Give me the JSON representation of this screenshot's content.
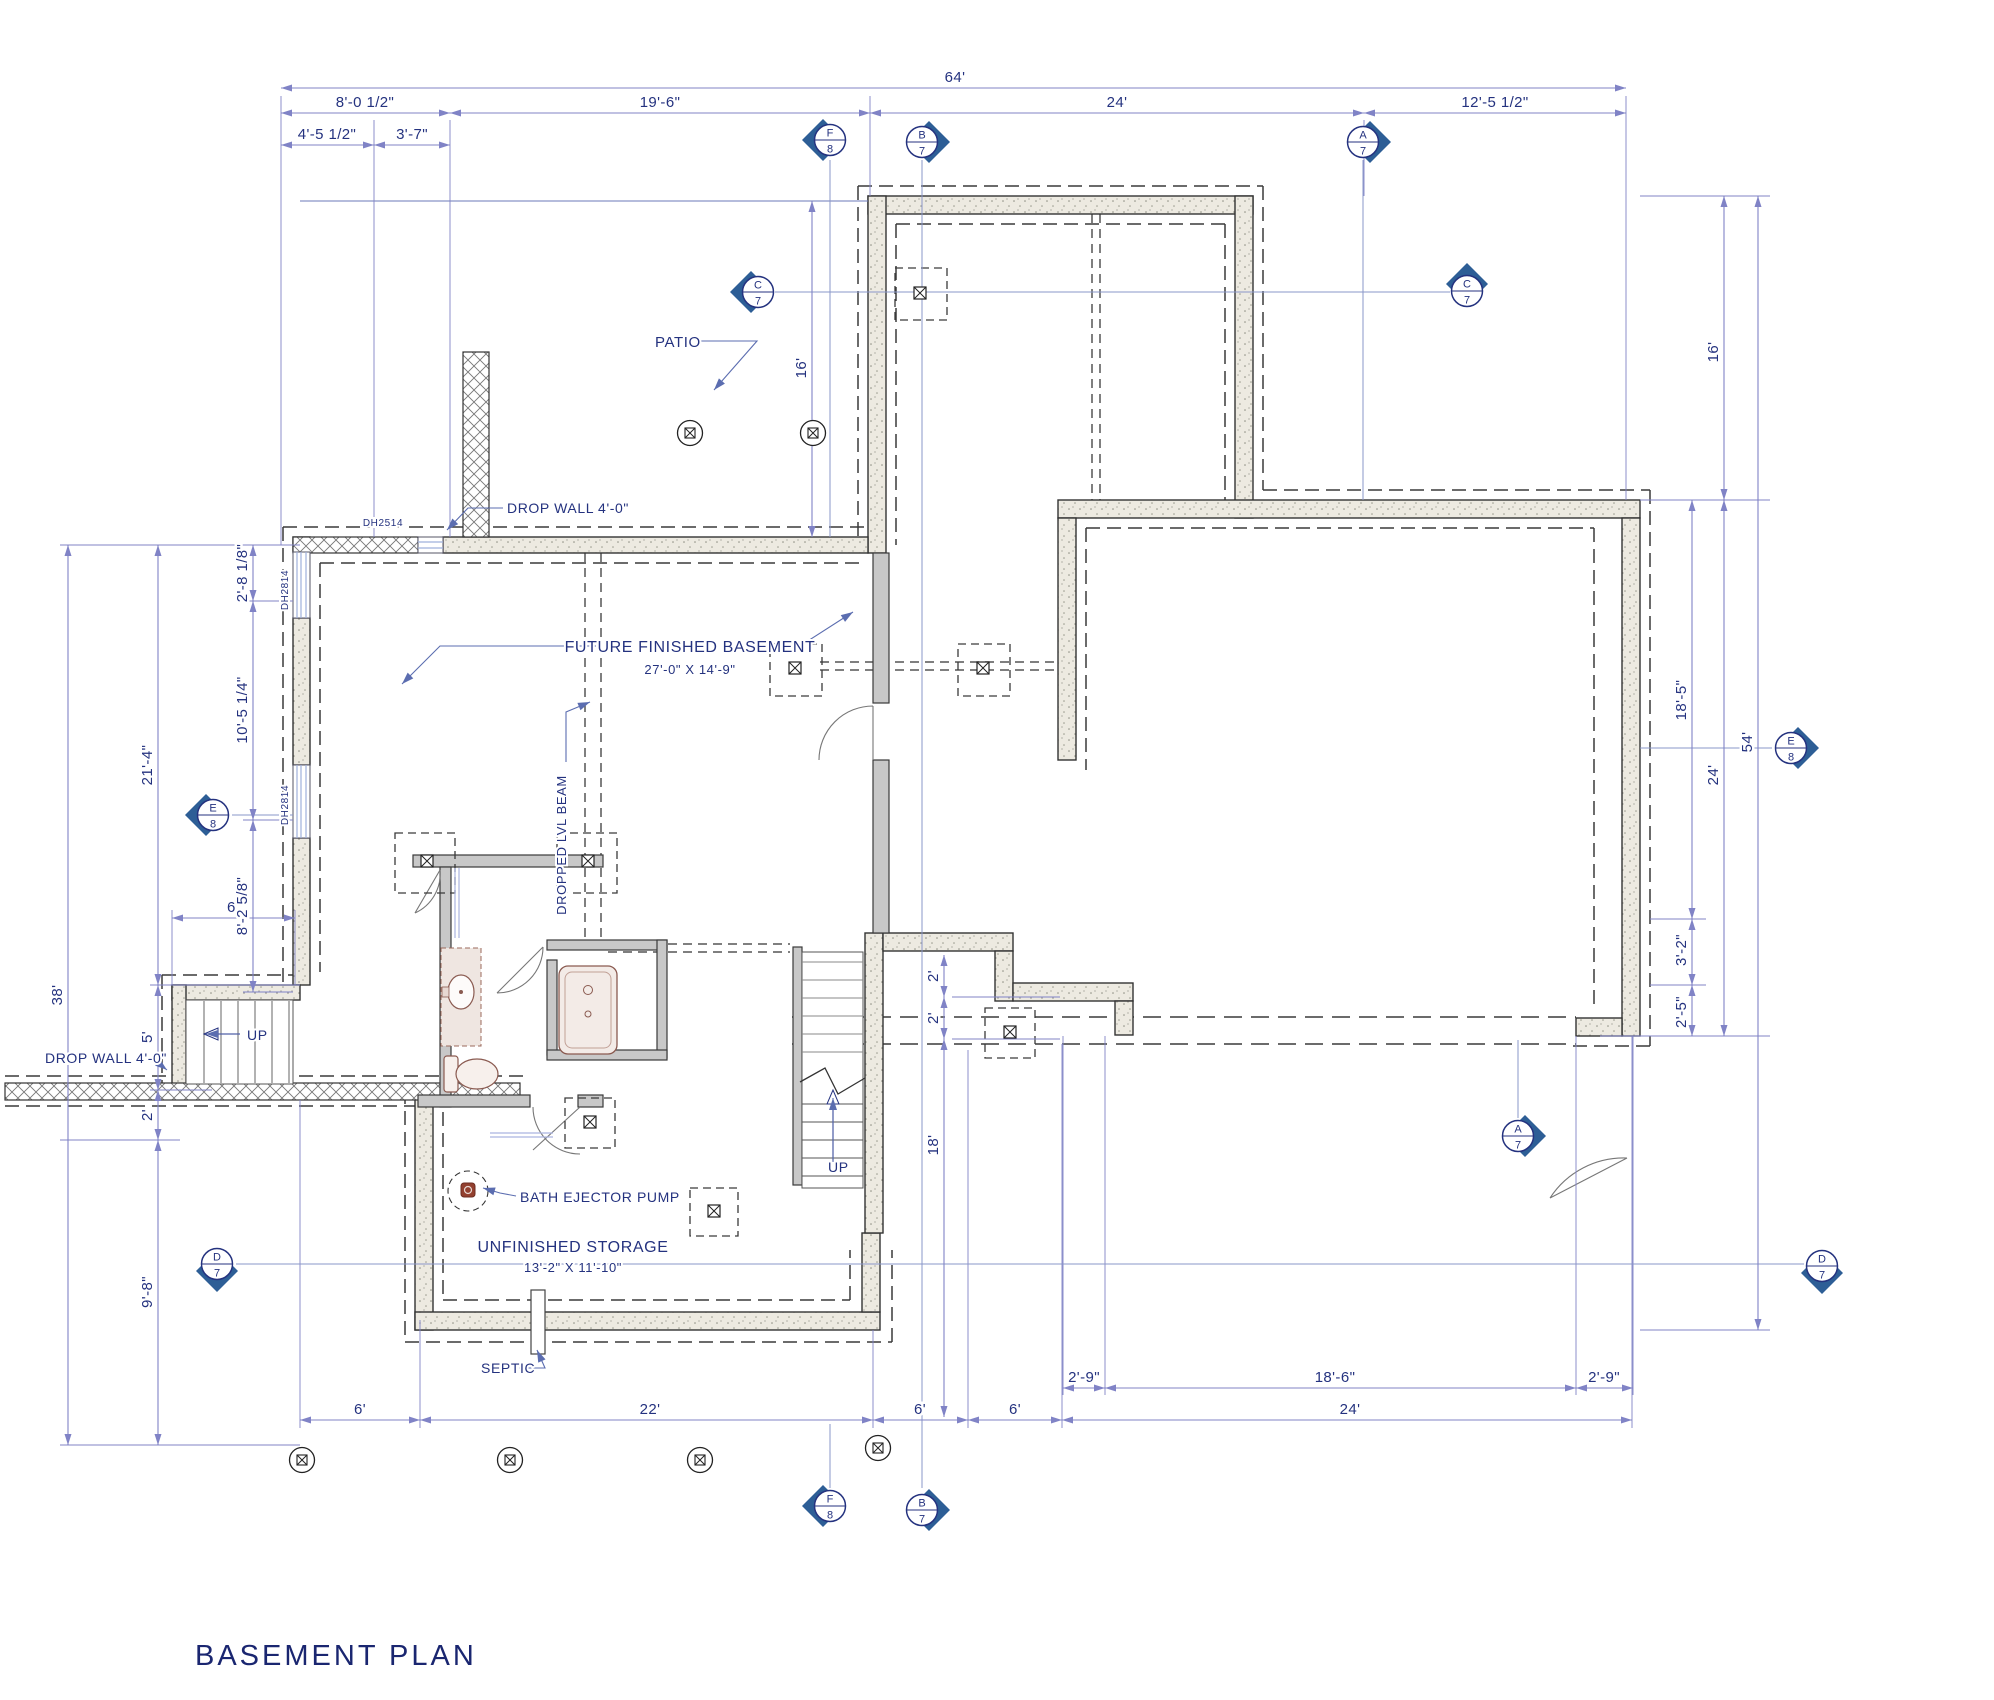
{
  "title": {
    "text": "BASEMENT PLAN"
  },
  "colors": {
    "annotation_text": "#24327f",
    "dimension_line": "#8083c6",
    "section_line": "#8a97c9",
    "marker_diamond": "#2d5e96",
    "wall_outline": "#333333",
    "concrete_fill": "#edeae1",
    "interior_wall": "#c8c8c8",
    "fixture": "#8a5a50",
    "pump_red": "#93402f"
  },
  "dims": [
    {
      "t": "64'",
      "x1": 281,
      "x2": 1626,
      "y": 88,
      "tx": 955,
      "ty": 82
    },
    {
      "t": "8'-0 1/2\"",
      "x1": 281,
      "x2": 450,
      "y": 113,
      "tx": 365,
      "ty": 107
    },
    {
      "t": "19'-6\"",
      "x1": 450,
      "x2": 870,
      "y": 113,
      "tx": 660,
      "ty": 107
    },
    {
      "t": "24'",
      "x1": 870,
      "x2": 1364,
      "y": 113,
      "tx": 1117,
      "ty": 107
    },
    {
      "t": "12'-5 1/2\"",
      "x1": 1364,
      "x2": 1626,
      "y": 113,
      "tx": 1495,
      "ty": 107
    },
    {
      "t": "4'-5 1/2\"",
      "x1": 281,
      "x2": 374,
      "y": 145,
      "tx": 327,
      "ty": 139
    },
    {
      "t": "3'-7\"",
      "x1": 374,
      "x2": 450,
      "y": 145,
      "tx": 412,
      "ty": 139
    },
    {
      "t": "6'",
      "x1": 300,
      "x2": 420,
      "y": 1420,
      "tx": 360,
      "ty": 1414
    },
    {
      "t": "22'",
      "x1": 420,
      "x2": 873,
      "y": 1420,
      "tx": 650,
      "ty": 1414
    },
    {
      "t": "6'",
      "x1": 873,
      "x2": 968,
      "y": 1420,
      "tx": 920,
      "ty": 1414
    },
    {
      "t": "6'",
      "x1": 968,
      "x2": 1062,
      "y": 1420,
      "tx": 1015,
      "ty": 1414
    },
    {
      "t": "24'",
      "x1": 1062,
      "x2": 1632,
      "y": 1420,
      "tx": 1350,
      "ty": 1414
    },
    {
      "t": "2'-9\"",
      "x1": 1063,
      "x2": 1105,
      "y": 1388,
      "tx": 1084,
      "ty": 1382
    },
    {
      "t": "18'-6\"",
      "x1": 1105,
      "x2": 1576,
      "y": 1388,
      "tx": 1335,
      "ty": 1382
    },
    {
      "t": "2'-9\"",
      "x1": 1576,
      "x2": 1633,
      "y": 1388,
      "tx": 1604,
      "ty": 1382
    },
    {
      "t": "6'",
      "x1": 172,
      "x2": 295,
      "y": 918,
      "tx": 233,
      "ty": 912
    },
    {
      "t": "38'",
      "x": 68,
      "y1": 545,
      "y2": 1445,
      "tx": 62,
      "ty": 995,
      "rot": -90
    },
    {
      "t": "21'-4\"",
      "x": 158,
      "y1": 545,
      "y2": 985,
      "tx": 152,
      "ty": 765,
      "rot": -90
    },
    {
      "t": "5'",
      "x": 158,
      "y1": 985,
      "y2": 1090,
      "tx": 152,
      "ty": 1037,
      "rot": -90
    },
    {
      "t": "2'",
      "x": 158,
      "y1": 1090,
      "y2": 1140,
      "tx": 152,
      "ty": 1115,
      "rot": -90
    },
    {
      "t": "9'-8\"",
      "x": 158,
      "y1": 1140,
      "y2": 1445,
      "tx": 152,
      "ty": 1292,
      "rot": -90
    },
    {
      "t": "2'-8 1/8\"",
      "x": 253,
      "y1": 545,
      "y2": 601,
      "tx": 247,
      "ty": 573,
      "rot": -90
    },
    {
      "t": "10'-5 1/4\"",
      "x": 253,
      "y1": 601,
      "y2": 820,
      "tx": 247,
      "ty": 710,
      "rot": -90
    },
    {
      "t": "8'-2 5/8\"",
      "x": 253,
      "y1": 820,
      "y2": 992,
      "tx": 247,
      "ty": 906,
      "rot": -90
    },
    {
      "t": "16'",
      "x": 812,
      "y1": 201,
      "y2": 537,
      "tx": 806,
      "ty": 368,
      "rot": -90
    },
    {
      "t": "16'",
      "x": 1724,
      "y1": 196,
      "y2": 500,
      "tx": 1718,
      "ty": 352,
      "rot": -90
    },
    {
      "t": "24'",
      "x": 1724,
      "y1": 500,
      "y2": 1036,
      "tx": 1718,
      "ty": 775,
      "rot": -90
    },
    {
      "t": "18'-5\"",
      "x": 1692,
      "y1": 500,
      "y2": 919,
      "tx": 1686,
      "ty": 700,
      "rot": -90
    },
    {
      "t": "3'-2\"",
      "x": 1692,
      "y1": 919,
      "y2": 985,
      "tx": 1686,
      "ty": 950,
      "rot": -90
    },
    {
      "t": "2'-5\"",
      "x": 1692,
      "y1": 985,
      "y2": 1036,
      "tx": 1686,
      "ty": 1012,
      "rot": -90
    },
    {
      "t": "54'",
      "x": 1758,
      "y1": 196,
      "y2": 1330,
      "tx": 1752,
      "ty": 742,
      "rot": -90
    },
    {
      "t": "2'",
      "x": 944,
      "y1": 955,
      "y2": 997,
      "tx": 938,
      "ty": 976,
      "rot": -90
    },
    {
      "t": "2'",
      "x": 944,
      "y1": 997,
      "y2": 1039,
      "tx": 938,
      "ty": 1018,
      "rot": -90
    },
    {
      "t": "18'",
      "x": 944,
      "y1": 1039,
      "y2": 1417,
      "tx": 938,
      "ty": 1145,
      "rot": -90
    }
  ],
  "labels": [
    {
      "id": "patio",
      "text": "PATIO",
      "x": 655,
      "y": 347,
      "size": 15,
      "anchor": "start"
    },
    {
      "id": "future-basement",
      "text": "FUTURE FINISHED BASEMENT",
      "x": 690,
      "y": 652,
      "size": 16,
      "anchor": "middle"
    },
    {
      "id": "future-basement-size",
      "text": "27'-0\" X 14'-9\"",
      "x": 690,
      "y": 674,
      "size": 13,
      "anchor": "middle"
    },
    {
      "id": "unfinished-storage",
      "text": "UNFINISHED STORAGE",
      "x": 573,
      "y": 1252,
      "size": 16,
      "anchor": "middle"
    },
    {
      "id": "unfinished-storage-size",
      "text": "13'-2\" X 11'-10\"",
      "x": 573,
      "y": 1272,
      "size": 13,
      "anchor": "middle"
    },
    {
      "id": "dropped-lvl-beam",
      "text": "DROPPED LVL BEAM",
      "x": 566,
      "y": 845,
      "size": 13,
      "anchor": "middle",
      "rot": -90
    },
    {
      "id": "drop-wall-top",
      "text": "DROP WALL 4'-0\"",
      "x": 507,
      "y": 513,
      "size": 14,
      "anchor": "start"
    },
    {
      "id": "drop-wall-left",
      "text": "DROP WALL 4'-0\"",
      "x": 45,
      "y": 1063,
      "size": 14,
      "anchor": "start"
    },
    {
      "id": "bath-ejector-pump",
      "text": "BATH EJECTOR PUMP",
      "x": 520,
      "y": 1202,
      "size": 14,
      "anchor": "start"
    },
    {
      "id": "septic",
      "text": "SEPTIC",
      "x": 481,
      "y": 1373,
      "size": 14,
      "anchor": "start"
    },
    {
      "id": "up-main-stair",
      "text": "UP",
      "x": 828,
      "y": 1172,
      "size": 14,
      "anchor": "start"
    },
    {
      "id": "up-left-stair",
      "text": "UP",
      "x": 247,
      "y": 1040,
      "size": 14,
      "anchor": "start"
    },
    {
      "id": "window-top",
      "text": "DH2514",
      "x": 383,
      "y": 526,
      "size": 10,
      "anchor": "middle"
    },
    {
      "id": "window-left-upper",
      "text": "DH2814",
      "x": 288,
      "y": 590,
      "size": 10,
      "anchor": "middle",
      "rot": -90
    },
    {
      "id": "window-left-lower",
      "text": "DH2814",
      "x": 288,
      "y": 805,
      "size": 10,
      "anchor": "middle",
      "rot": -90
    }
  ],
  "leaders": [
    {
      "for": "patio",
      "pts": [
        [
          700,
          341
        ],
        [
          757,
          341
        ],
        [
          714,
          390
        ]
      ]
    },
    {
      "for": "future-basement",
      "pts": [
        [
          596,
          646
        ],
        [
          440,
          646
        ],
        [
          402,
          684
        ]
      ]
    },
    {
      "for": "future-basement",
      "pts": [
        [
          784,
          646
        ],
        [
          800,
          646
        ],
        [
          853,
          612
        ]
      ]
    },
    {
      "for": "dropped-lvl-beam",
      "pts": [
        [
          566,
          762
        ],
        [
          566,
          712
        ],
        [
          590,
          702
        ]
      ]
    },
    {
      "for": "drop-wall-top",
      "pts": [
        [
          503,
          508
        ],
        [
          468,
          508
        ],
        [
          447,
          530
        ]
      ]
    },
    {
      "for": "drop-wall-left",
      "pts": [
        [
          142,
          1058
        ],
        [
          152,
          1058
        ],
        [
          167,
          1070
        ]
      ]
    },
    {
      "for": "bath-ejector-pump",
      "pts": [
        [
          516,
          1196
        ],
        [
          500,
          1193
        ],
        [
          483,
          1188
        ]
      ]
    },
    {
      "for": "septic",
      "pts": [
        [
          519,
          1368
        ],
        [
          545,
          1368
        ],
        [
          537,
          1350
        ]
      ]
    },
    {
      "for": "up-main-stair",
      "pts": [
        [
          833,
          1162
        ],
        [
          833,
          1098
        ]
      ]
    },
    {
      "for": "up-left-stair",
      "pts": [
        [
          240,
          1034
        ],
        [
          206,
          1034
        ]
      ]
    }
  ],
  "markers": [
    {
      "letter": "F",
      "number": "8",
      "x": 830,
      "y": 140,
      "dir": "left"
    },
    {
      "letter": "B",
      "number": "7",
      "x": 922,
      "y": 142,
      "dir": "right"
    },
    {
      "letter": "A",
      "number": "7",
      "x": 1363,
      "y": 142,
      "dir": "right"
    },
    {
      "letter": "C",
      "number": "7",
      "x": 758,
      "y": 292,
      "dir": "left"
    },
    {
      "letter": "C",
      "number": "7",
      "x": 1467,
      "y": 291,
      "dir": "up"
    },
    {
      "letter": "E",
      "number": "8",
      "x": 213,
      "y": 815,
      "dir": "left"
    },
    {
      "letter": "E",
      "number": "8",
      "x": 1791,
      "y": 748,
      "dir": "right"
    },
    {
      "letter": "D",
      "number": "7",
      "x": 217,
      "y": 1264,
      "dir": "down"
    },
    {
      "letter": "D",
      "number": "7",
      "x": 1822,
      "y": 1266,
      "dir": "down"
    },
    {
      "letter": "F",
      "number": "8",
      "x": 830,
      "y": 1506,
      "dir": "left"
    },
    {
      "letter": "B",
      "number": "7",
      "x": 922,
      "y": 1510,
      "dir": "right"
    },
    {
      "letter": "A",
      "number": "7",
      "x": 1518,
      "y": 1136,
      "dir": "right"
    }
  ],
  "piers": [
    [
      690,
      433
    ],
    [
      813,
      433
    ],
    [
      302,
      1460
    ],
    [
      510,
      1460
    ],
    [
      700,
      1460
    ],
    [
      878,
      1448
    ]
  ],
  "posts": [
    [
      427,
      861
    ],
    [
      588,
      861
    ],
    [
      920,
      293
    ],
    [
      795,
      668
    ],
    [
      983,
      668
    ],
    [
      1010,
      1032
    ],
    [
      590,
      1122
    ],
    [
      714,
      1211
    ]
  ],
  "extensions": [
    [
      281,
      96,
      281,
      545
    ],
    [
      374,
      120,
      374,
      537
    ],
    [
      450,
      120,
      450,
      537
    ],
    [
      870,
      96,
      870,
      196
    ],
    [
      1364,
      120,
      1364,
      196
    ],
    [
      1626,
      96,
      1626,
      500
    ],
    [
      300,
      1100,
      300,
      1428
    ],
    [
      420,
      1320,
      420,
      1428
    ],
    [
      873,
      1330,
      873,
      1428
    ],
    [
      968,
      1050,
      968,
      1428
    ],
    [
      1062,
      1044,
      1062,
      1428
    ],
    [
      1632,
      1036,
      1632,
      1428
    ],
    [
      1063,
      1036,
      1063,
      1395
    ],
    [
      1105,
      1036,
      1105,
      1395
    ],
    [
      1576,
      1036,
      1576,
      1395
    ],
    [
      1633,
      1036,
      1633,
      1395
    ],
    [
      60,
      545,
      300,
      545
    ],
    [
      150,
      985,
      300,
      985
    ],
    [
      150,
      1090,
      212,
      1090
    ],
    [
      60,
      1140,
      180,
      1140
    ],
    [
      60,
      1445,
      300,
      1445
    ],
    [
      243,
      601,
      293,
      601
    ],
    [
      243,
      820,
      293,
      820
    ],
    [
      243,
      992,
      293,
      992
    ],
    [
      1640,
      196,
      1770,
      196
    ],
    [
      1640,
      500,
      1770,
      500
    ],
    [
      1650,
      919,
      1706,
      919
    ],
    [
      1650,
      985,
      1706,
      985
    ],
    [
      1600,
      1036,
      1770,
      1036
    ],
    [
      1640,
      1330,
      1770,
      1330
    ],
    [
      172,
      910,
      172,
      985
    ],
    [
      295,
      910,
      295,
      985
    ],
    [
      952,
      997,
      1060,
      997
    ],
    [
      952,
      1039,
      1060,
      1039
    ]
  ],
  "sections": [
    [
      830,
      160,
      830,
      537
    ],
    [
      922,
      160,
      922,
      1488
    ],
    [
      1363,
      160,
      1363,
      500
    ],
    [
      1518,
      1040,
      1518,
      1118
    ],
    [
      830,
      1424,
      830,
      1488
    ],
    [
      775,
      292,
      1450,
      292
    ],
    [
      232,
      815,
      293,
      815
    ],
    [
      1640,
      748,
      1772,
      748
    ],
    [
      236,
      1264,
      1804,
      1264
    ]
  ]
}
